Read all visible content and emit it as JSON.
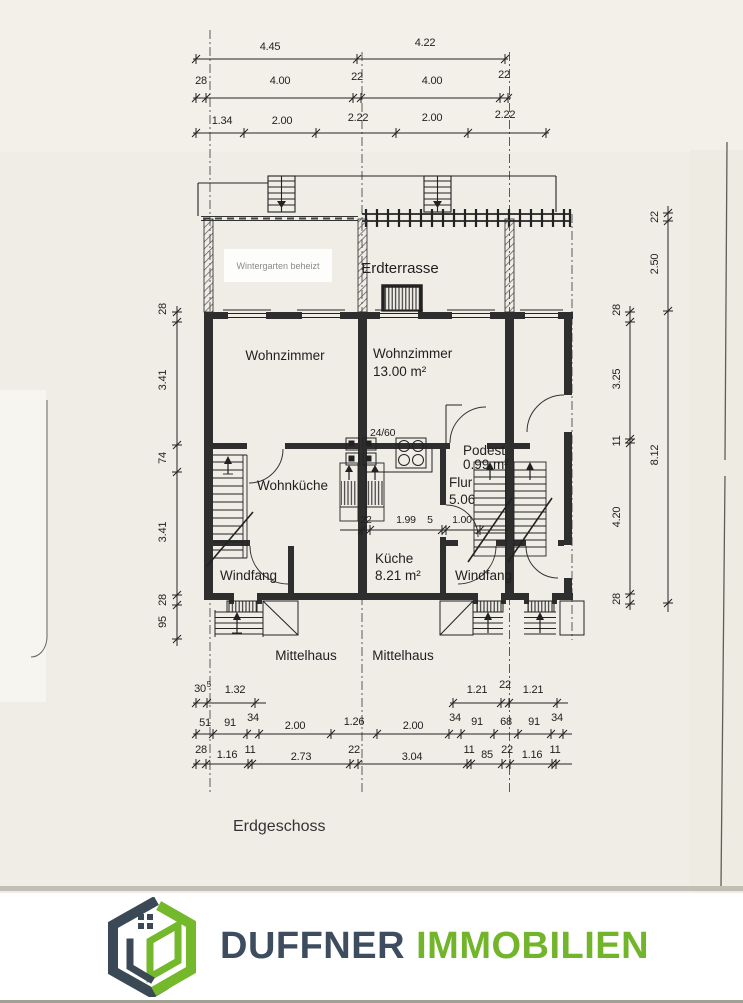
{
  "plan": {
    "floor_label": "Erdgeschoss",
    "rooms": {
      "wintergarten": "Wintergarten beheizt",
      "erdterrasse": "Erdterrasse",
      "wz_left": "Wohnzimmer",
      "wz_mid": "Wohnzimmer",
      "wz_mid_area": "13.00 m²",
      "wohnkueche": "Wohnküche",
      "kueche": "Küche",
      "kueche_area": "8.21 m²",
      "flur": "Flur",
      "flur_area": "5.06",
      "podest": "Podest",
      "podest_area": "0.99 m²",
      "windfang_l": "Windfang",
      "windfang_r": "Windfang",
      "mittelhaus_l": "Mittelhaus",
      "mittelhaus_r": "Mittelhaus",
      "door_note": "24/60"
    },
    "dims": {
      "top1": [
        "4.45",
        "4.22"
      ],
      "top2": [
        "28",
        "4.00",
        "22",
        "4.00",
        "22"
      ],
      "top3": [
        "1.34",
        "2.00",
        "2.22",
        "2.00",
        "2.22"
      ],
      "left": [
        "28",
        "3.41",
        "74",
        "3.41",
        "28",
        "95"
      ],
      "right_inner": [
        "28",
        "3.25",
        "11",
        "4.20",
        "28"
      ],
      "right_outer": [
        "22",
        "2.50",
        "8.12"
      ],
      "inner": [
        "22",
        "1.99",
        "5",
        "1.00"
      ],
      "b1l": [
        "30",
        "5",
        "1.32"
      ],
      "b1r": [
        "1.21",
        "22",
        "1.21"
      ],
      "b2": [
        "51",
        "91",
        "34",
        "2.00",
        "1.26",
        "2.00",
        "34",
        "91",
        "68",
        "91",
        "34"
      ],
      "b3": [
        "28",
        "1.16",
        "11",
        "2.73",
        "22",
        "3.04",
        "11",
        "85",
        "22",
        "1.16",
        "11"
      ]
    }
  },
  "footer": {
    "brand_first": "DUFFNER",
    "brand_second": "IMMOBILIEN",
    "colors": {
      "dark": "#3d4c5f",
      "green": "#72b52b"
    }
  }
}
